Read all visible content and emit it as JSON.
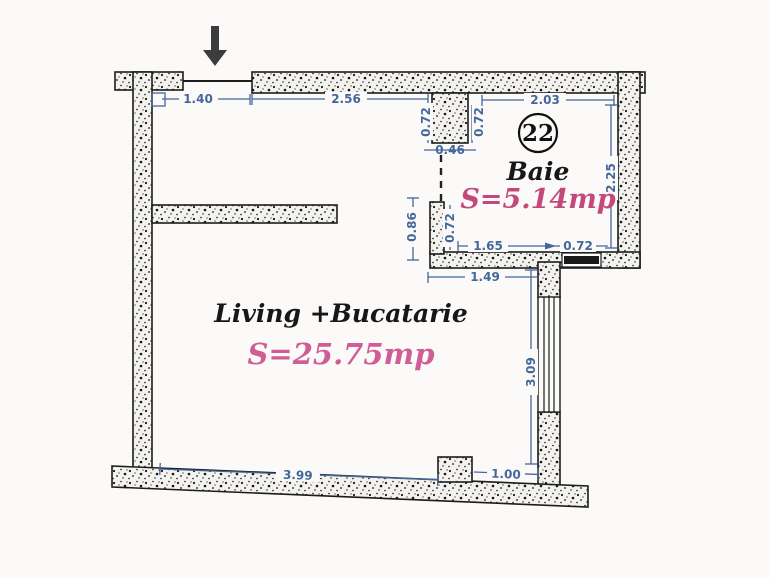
{
  "title": "Apartment unit floor plan",
  "rooms": {
    "bath": {
      "number": "22",
      "name": "Baie",
      "area": "S=5.14mp"
    },
    "living": {
      "name": "Living +Bucatarie",
      "area": "S=25.75mp"
    }
  },
  "dimensions": {
    "entry_door": "1.40",
    "living_top": "2.56",
    "bath_entry_left": "0.72",
    "bath_entry_right": "0.72",
    "bath_entry_width": "0.46",
    "bath_top": "2.03",
    "bath_right": "2.25",
    "bath_wall_height": "0.86",
    "bath_wall_inner": "0.72",
    "bath_bottom": "1.65",
    "bath_window": "0.72",
    "below_bath": "1.49",
    "living_right": "3.09",
    "living_bottom": "3.99",
    "living_bottom_right": "1.00"
  },
  "colors": {
    "dimension_blue": "#44679b",
    "area_pink_bath": "#c4487b",
    "area_pink_living": "#cf5d96",
    "wall_ink": "#1c1c1c",
    "arrow_gray": "#3c3c3c"
  }
}
